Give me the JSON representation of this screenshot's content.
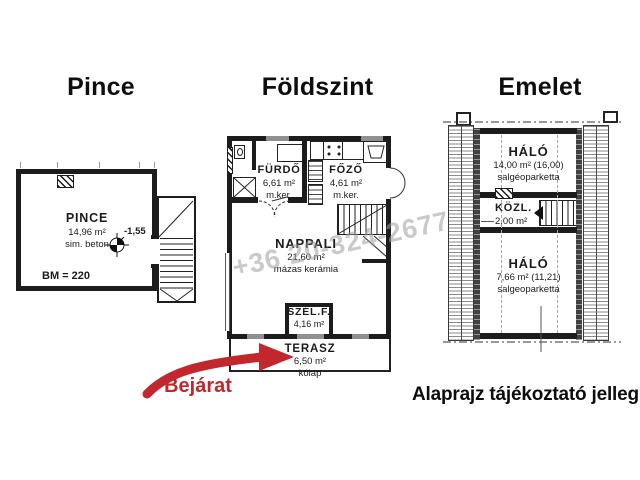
{
  "titles": {
    "left": "Pince",
    "middle": "Földszint",
    "right": "Emelet"
  },
  "pince": {
    "name": "PINCE",
    "area": "14,96 m²",
    "floor": "sim. beton",
    "level": "-1,55",
    "note": "BM = 220"
  },
  "foldszint": {
    "furdo": {
      "name": "FÜRDŐ",
      "area": "6,61 m²",
      "floor": "m.ker."
    },
    "fozo": {
      "name": "FŐZŐ",
      "area": "4,61 m²",
      "floor": "m.ker."
    },
    "nappali": {
      "name": "NAPPALI",
      "area": "21,60 m²",
      "floor": "mázas kerámia"
    },
    "szelf": {
      "name": "SZÉL.F.",
      "area": "4,16 m²"
    },
    "terasz": {
      "name": "TERASZ",
      "area": "6,50 m²",
      "floor": "kólap"
    }
  },
  "emelet": {
    "halo_top": {
      "name": "HÁLÓ",
      "area": "14,00 m² (16,00)",
      "floor": "salgéoparketta"
    },
    "kozl": {
      "name": "KÖZL.",
      "area": "2,00 m²"
    },
    "halo_bottom": {
      "name": "HÁLÓ",
      "area": "7,66 m² (11,21)",
      "floor": "salgeoparketta"
    }
  },
  "annotations": {
    "entrance": "Bejárat",
    "disclaimer": "Alaprajz tájékoztató jellegű!",
    "watermark": "+36 20-324-2677"
  },
  "colors": {
    "line": "#1c1c1c",
    "accent_red": "#c1272d",
    "watermark_gray": "#9e9e9e",
    "window_gray": "#909090"
  }
}
